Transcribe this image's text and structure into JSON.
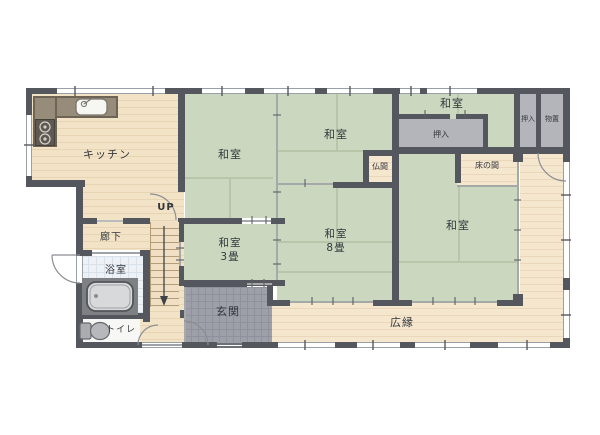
{
  "rooms": {
    "kitchen": {
      "label": "キッチン"
    },
    "washitsu_nw": {
      "label": "和室"
    },
    "washitsu_n": {
      "label": "和室"
    },
    "washitsu_ne": {
      "label": "和室"
    },
    "oshiire_main": {
      "label": "押入"
    },
    "oshiire_right": {
      "label": "押入"
    },
    "monooki": {
      "label": "物置"
    },
    "butsuma": {
      "label": "仏間"
    },
    "tokonoma": {
      "label": "床の間"
    },
    "washitsu_3": {
      "label": "和室",
      "size": "3畳"
    },
    "washitsu_8": {
      "label": "和室",
      "size": "8畳"
    },
    "washitsu_se": {
      "label": "和室"
    },
    "hiroen": {
      "label": "広縁"
    },
    "genkan": {
      "label": "玄関"
    },
    "rouka": {
      "label": "廊下"
    },
    "yokushitsu": {
      "label": "浴室"
    },
    "toire": {
      "label": "トイレ"
    },
    "stairs": {
      "label": "UP"
    }
  },
  "colors": {
    "wall": "#54575d",
    "tatami": "#cbd7bf",
    "wood_floor": "#f3e3c6",
    "veranda_wood": "#f5e6ce",
    "closet_gray": "#b3b5ba",
    "genkan_tile": "#9da0a9",
    "bath_tile": "#eef2f6",
    "counter": "#978b7a"
  }
}
